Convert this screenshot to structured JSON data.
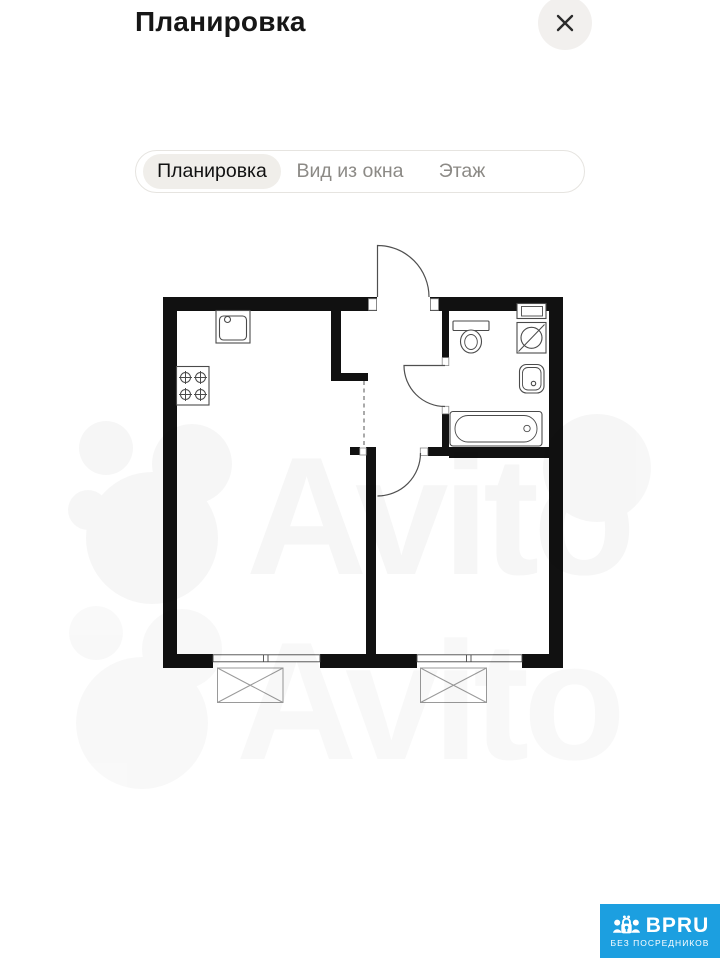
{
  "header": {
    "title": "Планировка"
  },
  "tabs": {
    "items": [
      {
        "label": "Планировка",
        "selected": true
      },
      {
        "label": "Вид из окна",
        "selected": false
      },
      {
        "label": "Этаж",
        "selected": false
      }
    ]
  },
  "watermark": {
    "text": "Avito"
  },
  "badge": {
    "brand": "BPRU",
    "subtitle": "БЕЗ ПОСРЕДНИКОВ"
  },
  "colors": {
    "badge_blue": "#1c9fe0",
    "wall_black": "#111111",
    "plan_line": "#4a4a4a",
    "thin_line": "#9a9a9a",
    "tab_selected_bg": "#f0eeea",
    "tab_border": "#e6e4e0",
    "muted_text": "#8c8a86",
    "close_circle_bg": "#f2f0ee",
    "title_text": "#161616"
  }
}
